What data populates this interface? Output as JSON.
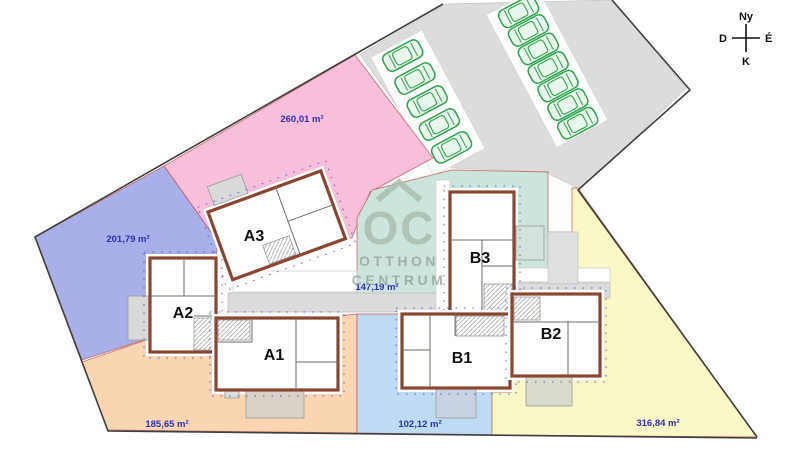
{
  "compass": {
    "top": "Ny",
    "right": "É",
    "bottom": "K",
    "left": "D"
  },
  "watermark": {
    "monogram": "OC",
    "line1": "OTTHON",
    "line2": "CENTRUM",
    "color": "#A9BCAF"
  },
  "lots": {
    "pink": {
      "area": "260,01 m²",
      "color": "#F8BFDA"
    },
    "lavender": {
      "area": "201,79 m²",
      "color": "#A9B0E9"
    },
    "orange": {
      "area": "185,65 m²",
      "color": "#FAD5B2"
    },
    "blue": {
      "area": "102,12 m²",
      "color": "#BFDBF4"
    },
    "yellow": {
      "area": "316,84 m²",
      "color": "#FAF8C6"
    },
    "teal": {
      "area": "147,19 m²",
      "color": "#CCE5DC"
    }
  },
  "units": {
    "a1": {
      "label": "A1"
    },
    "a2": {
      "label": "A2"
    },
    "a3": {
      "label": "A3"
    },
    "b1": {
      "label": "B1"
    },
    "b2": {
      "label": "B2"
    },
    "b3": {
      "label": "B3"
    }
  },
  "parking": {
    "car_count": 12,
    "car_color": "#2EA44E",
    "lot_fill": "#DCDCDC"
  },
  "styles": {
    "area_label_color": "#2B2FB8",
    "boundary_color": "#3F3F3F",
    "lot_border_color": "#C0504D",
    "wall_color": "#8A4630"
  }
}
